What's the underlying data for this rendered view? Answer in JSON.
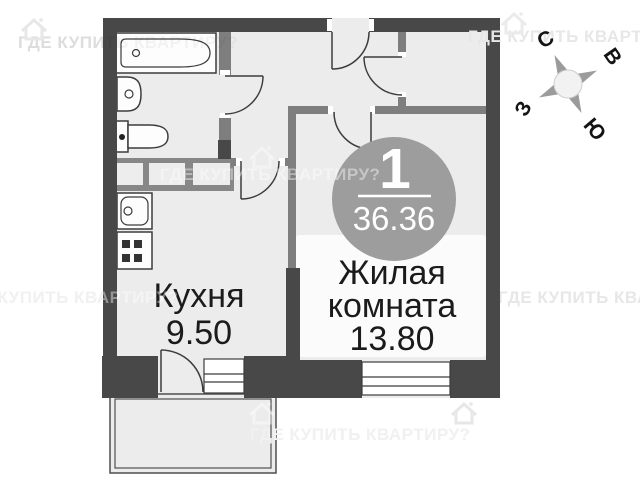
{
  "badge": {
    "room_count": "1",
    "total_area": "36.36"
  },
  "rooms": {
    "kitchen": {
      "name": "Кухня",
      "area": "9.50"
    },
    "living": {
      "name_line1": "Жилая",
      "name_line2": "комната",
      "area": "13.80"
    }
  },
  "compass": {
    "north": "С",
    "east": "В",
    "west": "З",
    "south": "Ю"
  },
  "watermark": {
    "text": "ГДЕ КУПИТЬ КВАРТИРУ?"
  },
  "colors": {
    "wall_dark": "#484848",
    "wall_partition": "#7e7e7e",
    "floor": "#ececec",
    "closet_band": "#878787",
    "badge_circle": "#9d9d9d",
    "label_text": "#1b1b1b",
    "watermark_gray": "#e7e7e7"
  }
}
